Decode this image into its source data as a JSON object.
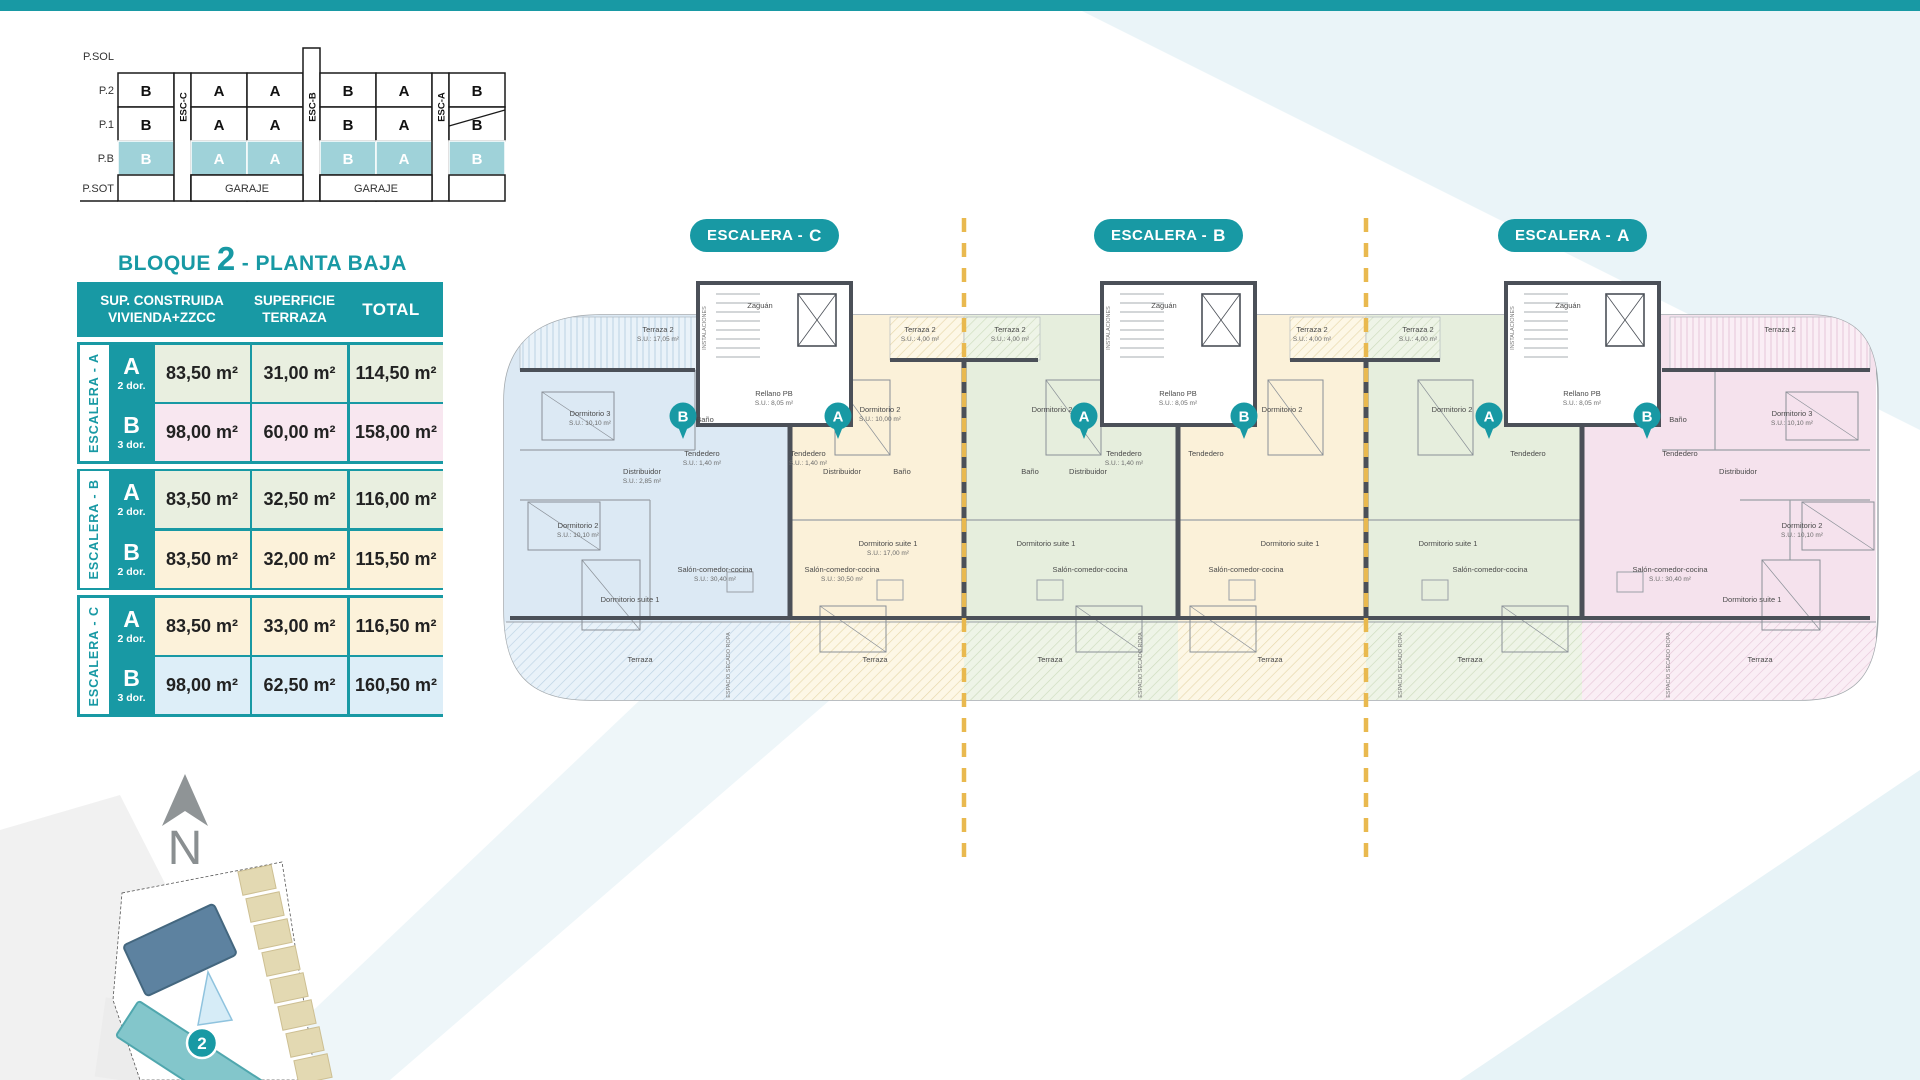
{
  "colors": {
    "accent": "#1899a4",
    "pb_highlight": "#9fd2d9",
    "dashed_line": "#e9b94f",
    "wall": "#4b5058",
    "unit_blue": "#dce9f4",
    "unit_cream": "#fbf1d9",
    "unit_green": "#e6eedd",
    "unit_pink": "#f5e2ed"
  },
  "section_diagram": {
    "row_labels": [
      "P.SOL",
      "P.2",
      "P.1",
      "P.B",
      "P.SOT"
    ],
    "columns": [
      {
        "type": "unit",
        "p2": "B",
        "p1": "B",
        "pb": "B"
      },
      {
        "type": "esc",
        "label": "ESC-C"
      },
      {
        "type": "unit",
        "p2": "A",
        "p1": "A",
        "pb": "A"
      },
      {
        "type": "unit",
        "p2": "A",
        "p1": "A",
        "pb": "A"
      },
      {
        "type": "esc",
        "label": "ESC-B",
        "tower": true
      },
      {
        "type": "unit",
        "p2": "B",
        "p1": "B",
        "pb": "B"
      },
      {
        "type": "unit",
        "p2": "A",
        "p1": "A",
        "pb": "A"
      },
      {
        "type": "esc",
        "label": "ESC-A"
      },
      {
        "type": "unit",
        "p2": "B",
        "p1": "B",
        "pb": "B"
      }
    ],
    "garaje_label": "GARAJE"
  },
  "legend": {
    "title_prefix": "BLOQUE",
    "title_number": "2",
    "title_suffix": "- PLANTA BAJA",
    "header": {
      "col1_line1": "SUP. CONSTRUIDA",
      "col1_line2": "VIVIENDA+ZZCC",
      "col2_line1": "SUPERFICIE",
      "col2_line2": "TERRAZA",
      "col3": "TOTAL"
    },
    "groups": [
      {
        "name": "ESCALERA - A",
        "rows": [
          {
            "letter": "A",
            "dorms": "2 dor.",
            "built": "83,50 m²",
            "terrace": "31,00 m²",
            "total": "114,50 m²",
            "bg": "#e9efe0"
          },
          {
            "letter": "B",
            "dorms": "3 dor.",
            "built": "98,00 m²",
            "terrace": "60,00 m²",
            "total": "158,00 m²",
            "bg": "#f8e7f0"
          }
        ]
      },
      {
        "name": "ESCALERA - B",
        "rows": [
          {
            "letter": "A",
            "dorms": "2 dor.",
            "built": "83,50 m²",
            "terrace": "32,50 m²",
            "total": "116,00 m²",
            "bg": "#e9efe0"
          },
          {
            "letter": "B",
            "dorms": "2 dor.",
            "built": "83,50 m²",
            "terrace": "32,00 m²",
            "total": "115,50 m²",
            "bg": "#fcf2da"
          }
        ]
      },
      {
        "name": "ESCALERA - C",
        "rows": [
          {
            "letter": "A",
            "dorms": "2 dor.",
            "built": "83,50 m²",
            "terrace": "33,00 m²",
            "total": "116,50 m²",
            "bg": "#fcf2da"
          },
          {
            "letter": "B",
            "dorms": "3 dor.",
            "built": "98,00 m²",
            "terrace": "62,50 m²",
            "total": "160,50 m²",
            "bg": "#ddeef8"
          }
        ]
      }
    ]
  },
  "plan": {
    "pills": [
      {
        "text": "ESCALERA -",
        "letter": "C",
        "x": 690
      },
      {
        "text": "ESCALERA -",
        "letter": "B",
        "x": 1094
      },
      {
        "text": "ESCALERA -",
        "letter": "A",
        "x": 1498
      }
    ],
    "badges": [
      {
        "letter": "B",
        "x": 193
      },
      {
        "letter": "A",
        "x": 348
      },
      {
        "letter": "A",
        "x": 594
      },
      {
        "letter": "B",
        "x": 754
      },
      {
        "letter": "A",
        "x": 999
      },
      {
        "letter": "B",
        "x": 1157
      }
    ],
    "zones": [
      {
        "x1": 14,
        "x2": 300,
        "color": "blue"
      },
      {
        "x1": 300,
        "x2": 474,
        "color": "cream"
      },
      {
        "x1": 474,
        "x2": 688,
        "color": "green"
      },
      {
        "x1": 688,
        "x2": 876,
        "color": "cream"
      },
      {
        "x1": 876,
        "x2": 1092,
        "color": "green"
      },
      {
        "x1": 1092,
        "x2": 1386,
        "color": "pink"
      }
    ],
    "cores": [
      {
        "x": 208,
        "zaguan": "Zaguán",
        "rellano": "Rellano PB",
        "rellano_sup": "S.U.: 8,05 m²",
        "inst": "INSTALACIONES"
      },
      {
        "x": 612,
        "zaguan": "Zaguán",
        "rellano": "Rellano PB",
        "rellano_sup": "S.U.: 8,05 m²",
        "inst": "INSTALACIONES"
      },
      {
        "x": 1016,
        "zaguan": "Zaguán",
        "rellano": "Rellano PB",
        "rellano_sup": "S.U.: 8,05 m²",
        "inst": "INSTALACIONES"
      }
    ],
    "rooms": [
      {
        "t": "Terraza 2",
        "s": "S.U.: 17,05 m²",
        "x": 168,
        "y": 122
      },
      {
        "t": "Dormitorio 3",
        "s": "S.U.: 10,10 m²",
        "x": 100,
        "y": 206
      },
      {
        "t": "Baño",
        "s": "",
        "x": 215,
        "y": 212
      },
      {
        "t": "Tendedero",
        "s": "S.U.: 1,40 m²",
        "x": 212,
        "y": 246
      },
      {
        "t": "Distribuidor",
        "s": "S.U.: 2,85 m²",
        "x": 152,
        "y": 264
      },
      {
        "t": "Dormitorio 2",
        "s": "S.U.: 10,10 m²",
        "x": 88,
        "y": 318
      },
      {
        "t": "Dormitorio suite 1",
        "s": "",
        "x": 140,
        "y": 392
      },
      {
        "t": "Salón-comedor-cocina",
        "s": "S.U.: 30,40 m²",
        "x": 225,
        "y": 362
      },
      {
        "t": "Tendedero",
        "s": "S.U.: 1,40 m²",
        "x": 318,
        "y": 246
      },
      {
        "t": "Terraza 2",
        "s": "S.U.: 4,00 m²",
        "x": 430,
        "y": 122
      },
      {
        "t": "Dormitorio 2",
        "s": "S.U.: 10,00 m²",
        "x": 390,
        "y": 202
      },
      {
        "t": "Distribuidor",
        "s": "",
        "x": 352,
        "y": 264
      },
      {
        "t": "Baño",
        "s": "",
        "x": 412,
        "y": 264
      },
      {
        "t": "Dormitorio suite 1",
        "s": "S.U.: 17,00 m²",
        "x": 398,
        "y": 336
      },
      {
        "t": "Salón-comedor-cocina",
        "s": "S.U.: 30,50 m²",
        "x": 352,
        "y": 362
      },
      {
        "t": "Terraza 2",
        "s": "S.U.: 4,00 m²",
        "x": 520,
        "y": 122
      },
      {
        "t": "Dormitorio 2",
        "s": "",
        "x": 562,
        "y": 202
      },
      {
        "t": "Baño",
        "s": "",
        "x": 540,
        "y": 264
      },
      {
        "t": "Distribuidor",
        "s": "",
        "x": 598,
        "y": 264
      },
      {
        "t": "Tendedero",
        "s": "S.U.: 1,40 m²",
        "x": 634,
        "y": 246
      },
      {
        "t": "Dormitorio suite 1",
        "s": "",
        "x": 556,
        "y": 336
      },
      {
        "t": "Salón-comedor-cocina",
        "s": "",
        "x": 600,
        "y": 362
      },
      {
        "t": "Terraza 2",
        "s": "S.U.: 4,00 m²",
        "x": 822,
        "y": 122
      },
      {
        "t": "Dormitorio 2",
        "s": "",
        "x": 792,
        "y": 202
      },
      {
        "t": "Tendedero",
        "s": "",
        "x": 716,
        "y": 246
      },
      {
        "t": "Dormitorio suite 1",
        "s": "",
        "x": 800,
        "y": 336
      },
      {
        "t": "Salón-comedor-cocina",
        "s": "",
        "x": 756,
        "y": 362
      },
      {
        "t": "Terraza 2",
        "s": "S.U.: 4,00 m²",
        "x": 928,
        "y": 122
      },
      {
        "t": "Dormitorio 2",
        "s": "",
        "x": 962,
        "y": 202
      },
      {
        "t": "Tendedero",
        "s": "",
        "x": 1038,
        "y": 246
      },
      {
        "t": "Dormitorio suite 1",
        "s": "",
        "x": 958,
        "y": 336
      },
      {
        "t": "Salón-comedor-cocina",
        "s": "",
        "x": 1000,
        "y": 362
      },
      {
        "t": "Terraza 2",
        "s": "",
        "x": 1290,
        "y": 122
      },
      {
        "t": "Dormitorio 3",
        "s": "S.U.: 10,10 m²",
        "x": 1302,
        "y": 206
      },
      {
        "t": "Baño",
        "s": "",
        "x": 1188,
        "y": 212
      },
      {
        "t": "Tendedero",
        "s": "",
        "x": 1190,
        "y": 246
      },
      {
        "t": "Distribuidor",
        "s": "",
        "x": 1248,
        "y": 264
      },
      {
        "t": "Dormitorio 2",
        "s": "S.U.: 10,10 m²",
        "x": 1312,
        "y": 318
      },
      {
        "t": "Dormitorio suite 1",
        "s": "",
        "x": 1262,
        "y": 392
      },
      {
        "t": "Salón-comedor-cocina",
        "s": "S.U.: 30,40 m²",
        "x": 1180,
        "y": 362
      }
    ],
    "terraza_label": "Terraza",
    "terraza_xs": [
      150,
      385,
      560,
      780,
      980,
      1270
    ],
    "secado_label": "ESPACIO SECADO ROPA",
    "secado_xs": [
      240,
      652,
      912,
      1180
    ]
  },
  "north_letter": "N",
  "site_map": {
    "block_badge": "2"
  }
}
